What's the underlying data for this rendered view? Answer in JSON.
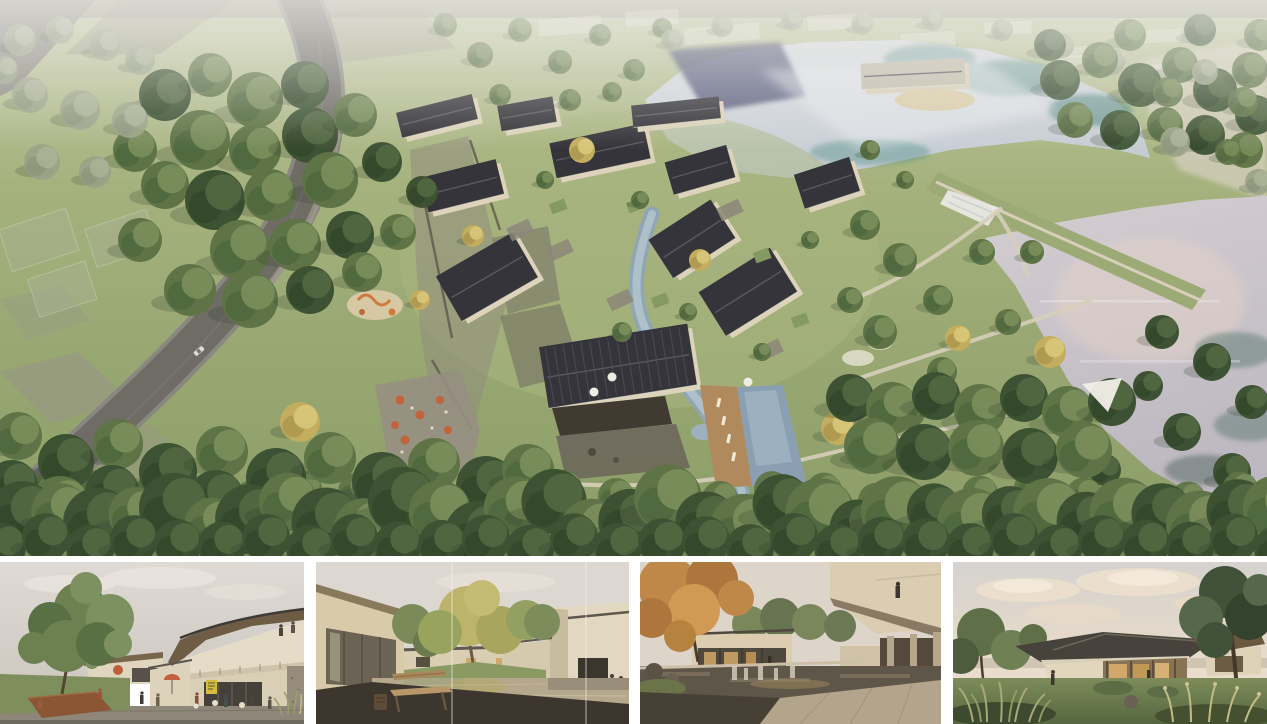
{
  "board": {
    "background": "#ffffff",
    "panel_count": 5
  },
  "colors": {
    "grass_light": "#c7cda6",
    "grass_mid": "#a2b07c",
    "grass_deep": "#8a9c66",
    "forest_dark": "#3c5232",
    "forest_green": "#5e7446",
    "forest_faded": "#9aa287",
    "tree_gold": "#c3ad5e",
    "roof_charcoal": "#35343a",
    "roof_pale": "#c2bbaa",
    "wall_cream": "#ddd3ba",
    "stone_gray": "#8f897c",
    "road_asphalt": "#6f6c66",
    "upper_lake": "#ced4da",
    "lake_teal": "#4f8a7f",
    "lake_reflection_blue": "#474a70",
    "lower_lake": "#c9c4c9",
    "lake_warm_sheen": "#e3d2c9",
    "pool_blue": "#8aa0b2",
    "deck_wood": "#b08a5c",
    "umbrella_orange": "#c2633c",
    "thumb_sky": "#ddd6d0",
    "thumb_sky_warm": "#e7dccd",
    "interior_glow": "#d2a96a",
    "paving_dark": "#443e35",
    "terrace_warm": "#b3a48c",
    "bench_wood": "#b3925f"
  }
}
